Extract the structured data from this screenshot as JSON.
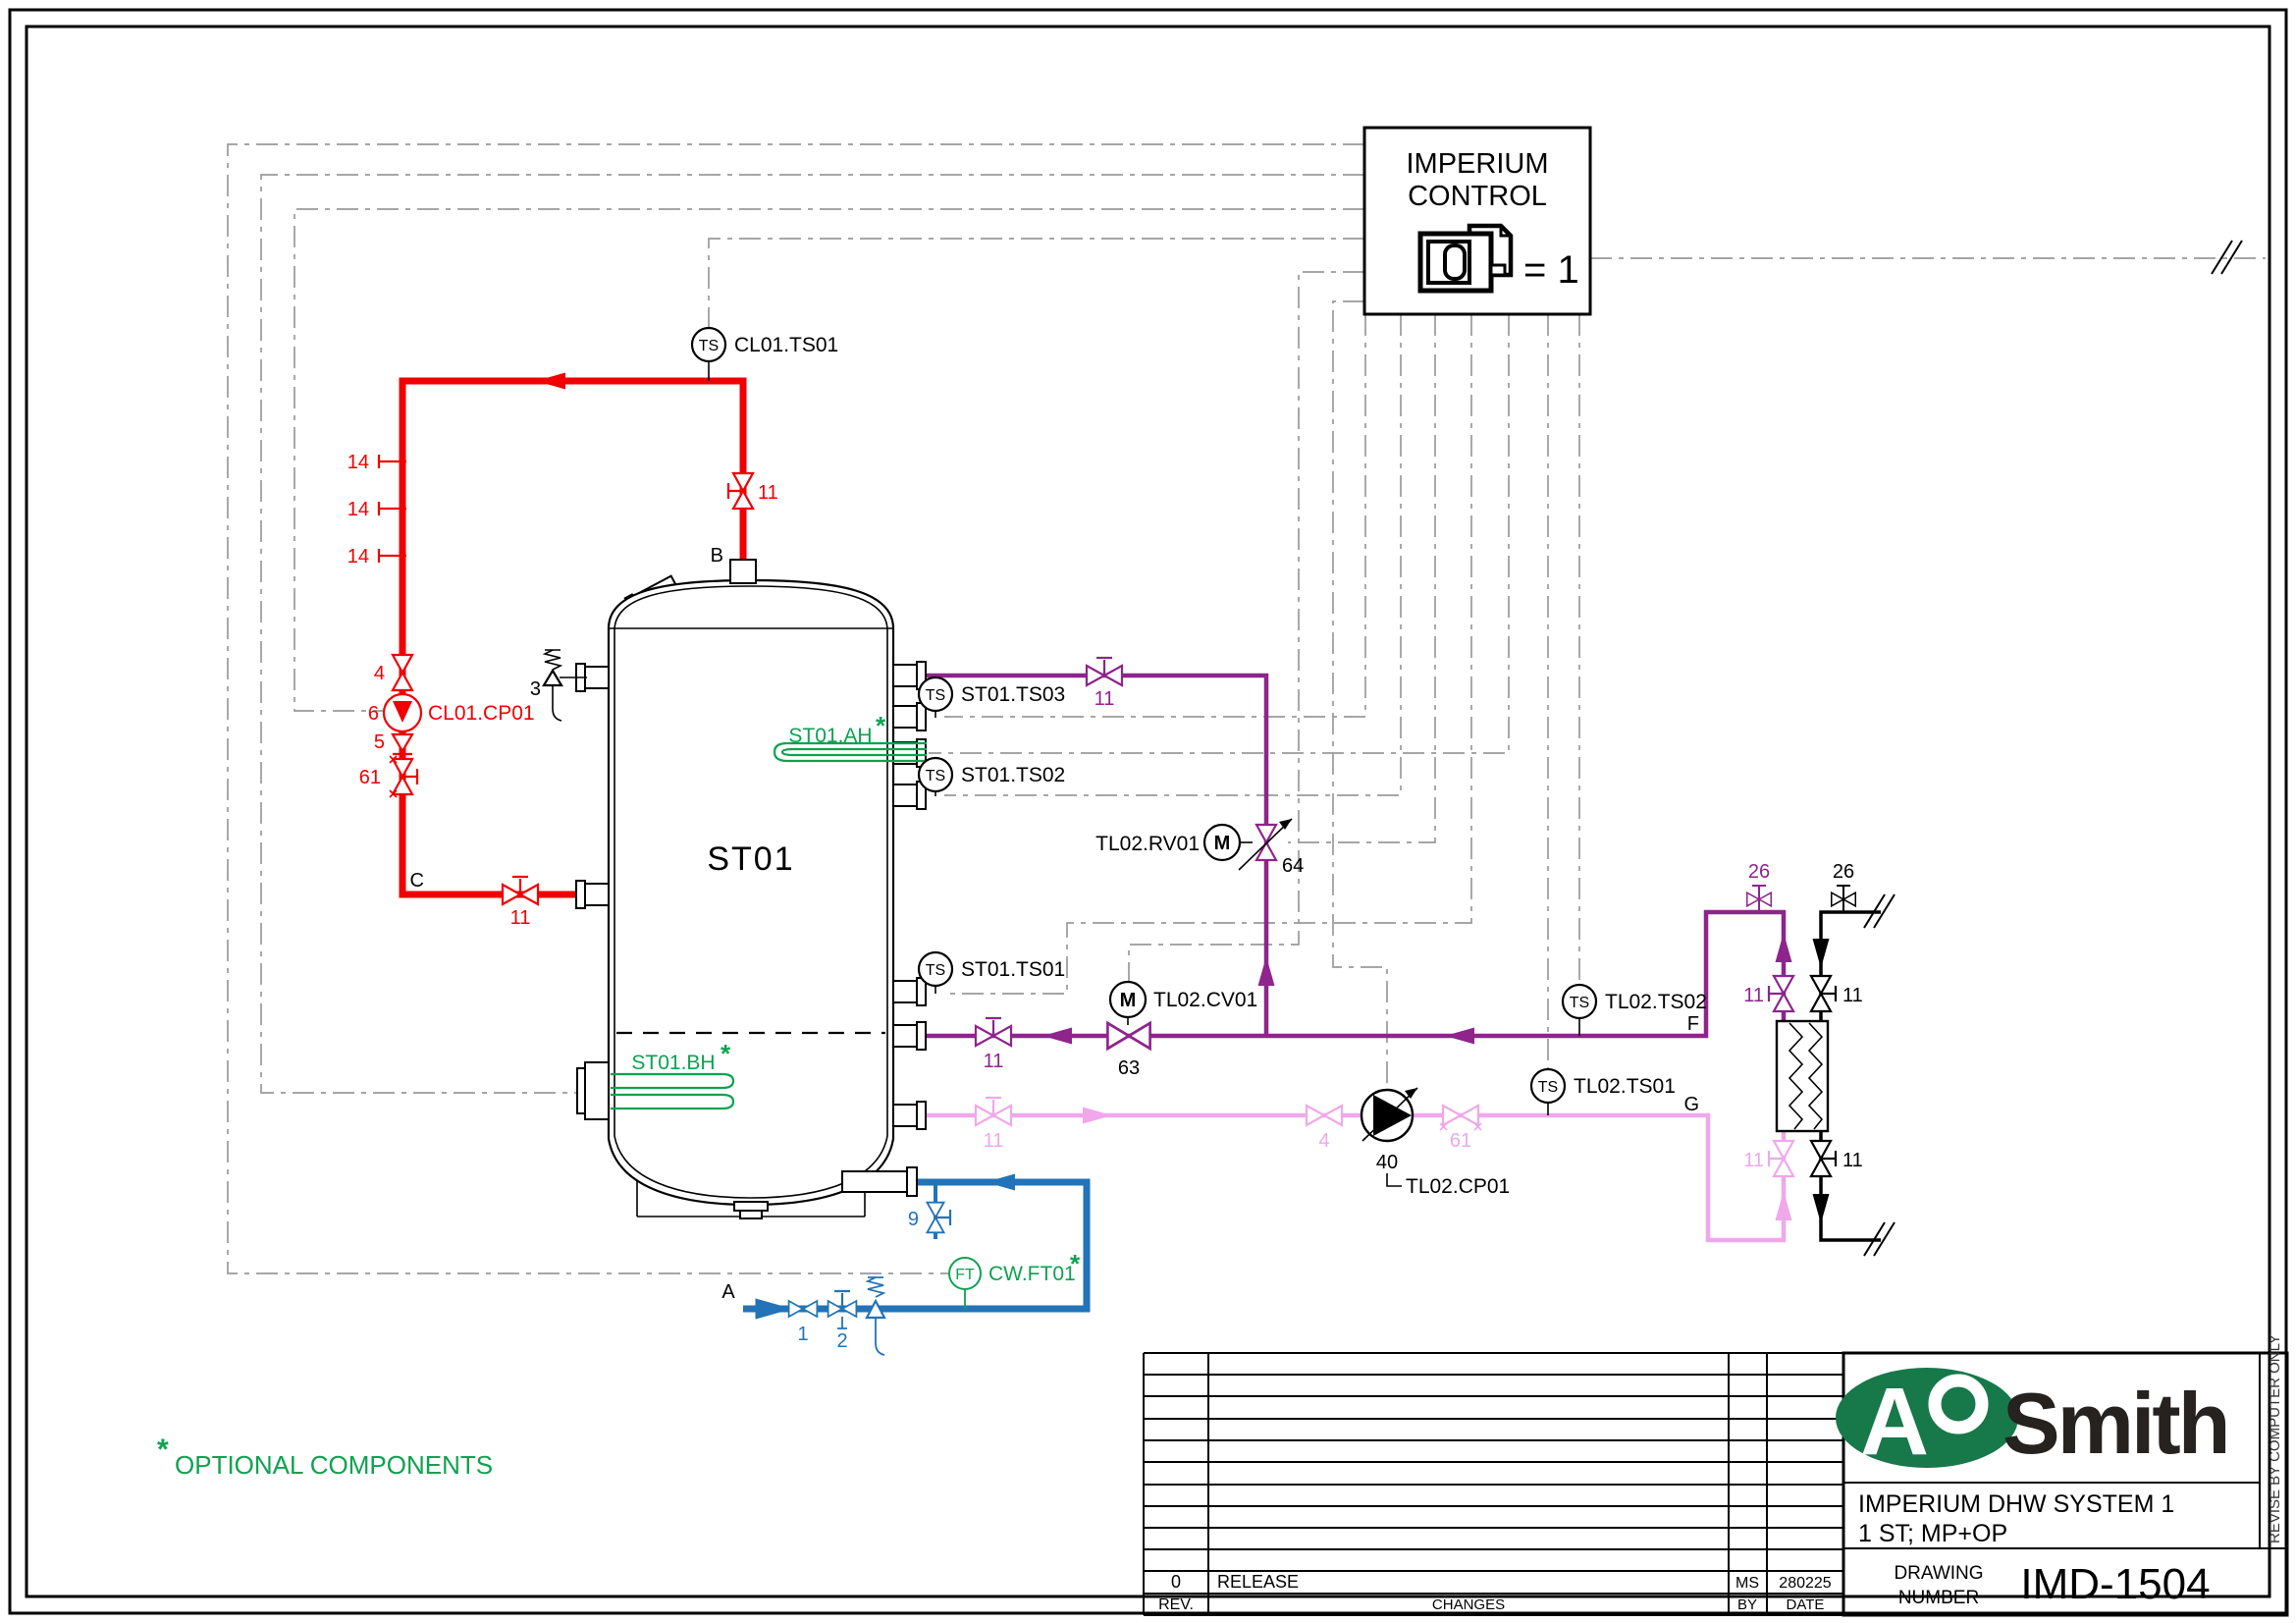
{
  "control_box": {
    "title_line1": "IMPERIUM",
    "title_line2": "CONTROL",
    "equation": "= 1"
  },
  "tank": {
    "label": "ST01"
  },
  "connection_points": {
    "a": "A",
    "b": "B",
    "c": "C",
    "f": "F",
    "g": "G"
  },
  "sensors": {
    "cl01_ts01": {
      "tag": "TS",
      "label": "CL01.TS01"
    },
    "st01_ts03": {
      "tag": "TS",
      "label": "ST01.TS03"
    },
    "st01_ts02": {
      "tag": "TS",
      "label": "ST01.TS02"
    },
    "st01_ts01": {
      "tag": "TS",
      "label": "ST01.TS01"
    },
    "tl02_ts02": {
      "tag": "TS",
      "label": "TL02.TS02"
    },
    "tl02_ts01": {
      "tag": "TS",
      "label": "TL02.TS01"
    },
    "tl02_rv01": {
      "tag": "M",
      "label": "TL02.RV01"
    },
    "tl02_cv01": {
      "tag": "M",
      "label": "TL02.CV01"
    },
    "cw_ft01": {
      "tag": "FT",
      "label": "CW.FT01",
      "marker": "*"
    }
  },
  "equipment": {
    "cl01_cp01": {
      "number": "6",
      "label": "CL01.CP01"
    },
    "tl02_cp01": {
      "number": "40",
      "label": "TL02.CP01"
    },
    "st01_ah": {
      "label": "ST01.AH",
      "marker": "*"
    },
    "st01_bh": {
      "label": "ST01.BH",
      "marker": "*"
    }
  },
  "valves": {
    "n1": "1",
    "n2": "2",
    "n3": "3",
    "n4": "4",
    "n5": "5",
    "n9": "9",
    "n11": "11",
    "n14": "14",
    "n26": "26",
    "n61": "61",
    "n63": "63",
    "n64": "64"
  },
  "notes": {
    "optional_marker": "*",
    "optional_text": "OPTIONAL COMPONENTS"
  },
  "title_block": {
    "brand_a": "A",
    "brand_o": "O",
    "brand_name": "Smith",
    "system_line1": "IMPERIUM DHW SYSTEM 1",
    "system_line2": "1 ST; MP+OP",
    "drawing_label_line1": "DRAWING",
    "drawing_label_line2": "NUMBER",
    "drawing_number": "IMD-1504",
    "side_note": "REVISE BY COMPUTER ONLY",
    "revision": {
      "rev_value": "0",
      "change_value": "RELEASE",
      "by_value": "MS",
      "date_value": "280225",
      "rev_header": "REV.",
      "changes_header": "CHANGES",
      "by_header": "BY",
      "date_header": "DATE"
    }
  },
  "colors": {
    "hot_supply_red": "#f00000",
    "secondary_supply_purple": "#8e248c",
    "secondary_return_pink": "#f0a8ea",
    "cold_water_blue": "#2273b8",
    "optional_green": "#0da24f",
    "control_gray": "#9a9a9a",
    "brand_green": "#17784a"
  }
}
